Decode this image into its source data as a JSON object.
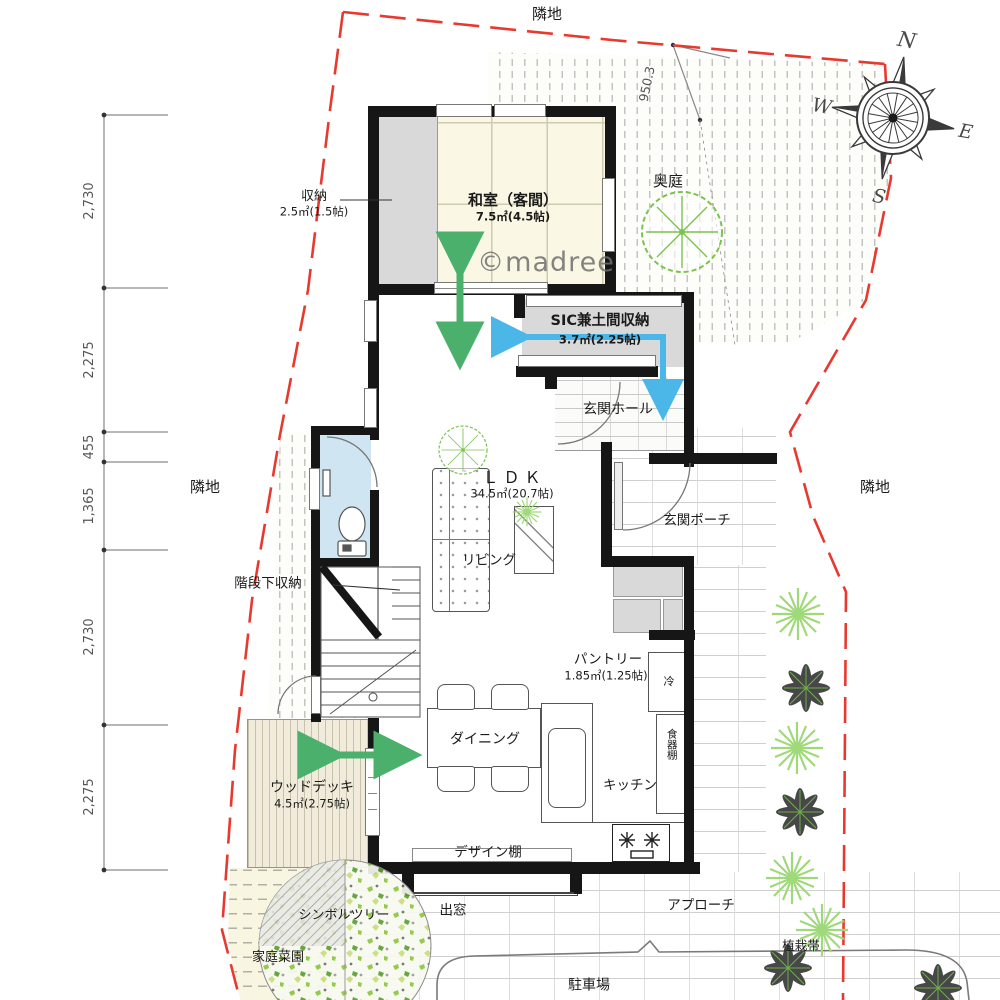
{
  "watermark": "©madree",
  "labels": {
    "neighbor_top": "隣地",
    "neighbor_left": "隣地",
    "neighbor_right": "隣地",
    "back_garden": "奥庭",
    "boundary_dimension": "950.3",
    "entrance_hall": "玄関ホール",
    "entrance_porch": "玄関ポーチ",
    "under_stairs_storage": "階段下収納",
    "living": "リビング",
    "dining": "ダイニング",
    "kitchen": "キッチン",
    "design_shelf": "デザイン棚",
    "bay_window": "出窓",
    "refrigerator": "冷",
    "cupboard": "食器棚",
    "symbol_tree": "シンボルツリー",
    "vegetable_garden": "家庭菜園",
    "approach": "アプローチ",
    "parking": "駐車場",
    "planting_strip": "植栽帯"
  },
  "rooms": {
    "washitsu": {
      "name": "和室（客間）",
      "area": "7.5㎡(4.5帖)"
    },
    "storage": {
      "name": "収納",
      "area": "2.5㎡(1.5帖)"
    },
    "sic": {
      "name": "SIC兼土間収納",
      "area": "3.7㎡(2.25帖)"
    },
    "ldk": {
      "name": "ＬＤＫ",
      "area": "34.5㎡(20.7帖)"
    },
    "pantry": {
      "name": "パントリー",
      "area": "1.85㎡(1.25帖)"
    },
    "wood_deck": {
      "name": "ウッドデッキ",
      "area": "4.5㎡(2.75帖)"
    }
  },
  "dimensions_left": [
    "2,730",
    "2,275",
    "455",
    "1,365",
    "2,730",
    "2,275"
  ],
  "compass": {
    "north": "N",
    "east": "E",
    "south": "S",
    "west": "W"
  },
  "colors": {
    "boundary_red": "#e8392f",
    "arrow_green": "#4bb06b",
    "arrow_blue": "#4ab7e8",
    "tatami_cream": "#faf7e4",
    "storage_gray": "#d9d9d9",
    "toilet_blue": "#cfe6f2",
    "plant_green": "#7bc24f"
  }
}
